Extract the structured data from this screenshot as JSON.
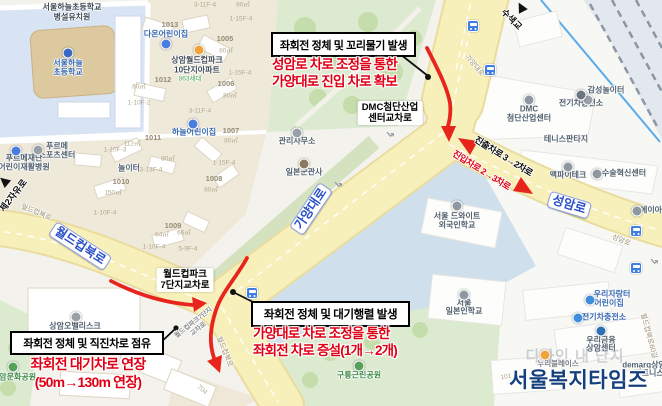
{
  "colors": {
    "red": "#e00016",
    "arrowred": "#e8251d",
    "roady": "#f8f0ba",
    "pillblue": "#2b50c8",
    "navy": "#16407d"
  },
  "annotations": {
    "top": {
      "issue": "좌회전 정체 및 꼬리물기 발생",
      "action1": "성암로 차로 조정을 통한",
      "action2": "가양대로 진입 차로 확보"
    },
    "bottom_center": {
      "issue": "좌회전 정체 및 대기행렬 발생",
      "action1": "가양대로 차로 조정을 통한",
      "action2": "좌회전 차로 증설(1개→2개)"
    },
    "bottom_left": {
      "issue": "좌회전 정체 및 직진차로 점유",
      "action1": "좌회전 대기차로 연장",
      "action2": "(50m→130m 연장)"
    }
  },
  "watermark": {
    "text": "서울복지타임즈"
  },
  "map": {
    "labels": [
      {
        "t": "서울하늘초등학교",
        "x": 72,
        "y": 8,
        "c": "poid"
      },
      {
        "t": "병설유치원",
        "x": 72,
        "y": 18,
        "c": "poid"
      },
      {
        "t": "서울하늘",
        "x": 68,
        "y": 64,
        "c": "poib"
      },
      {
        "t": "초등학교",
        "x": 68,
        "y": 73,
        "c": "poib"
      },
      {
        "t": "다온어린이집",
        "x": 166,
        "y": 35,
        "c": "poib"
      },
      {
        "t": "1013",
        "x": 170,
        "y": 25,
        "c": "bn"
      },
      {
        "t": "상암월드컵파크",
        "x": 197,
        "y": 61,
        "c": "poid"
      },
      {
        "t": "10단지아파트",
        "x": 197,
        "y": 71,
        "c": "poid"
      },
      {
        "t": "863세대",
        "x": 190,
        "y": 79,
        "c": "gsm"
      },
      {
        "t": "1012",
        "x": 163,
        "y": 80,
        "c": "bn"
      },
      {
        "t": "하늘어린이집",
        "x": 194,
        "y": 133,
        "c": "poib"
      },
      {
        "t": "80㎡",
        "x": 243,
        "y": 5,
        "c": "pn"
      },
      {
        "t": "1-15F-4",
        "x": 241,
        "y": 19,
        "c": "pn"
      },
      {
        "t": "1005",
        "x": 225,
        "y": 39,
        "c": "bn"
      },
      {
        "t": "80㎡",
        "x": 226,
        "y": 51,
        "c": "pn"
      },
      {
        "t": "1-15F-4",
        "x": 240,
        "y": 73,
        "c": "pn"
      },
      {
        "t": "1006",
        "x": 226,
        "y": 84,
        "c": "bn"
      },
      {
        "t": "80㎡",
        "x": 230,
        "y": 96,
        "c": "pn"
      },
      {
        "t": "3-11F-4",
        "x": 205,
        "y": 5,
        "c": "pn"
      },
      {
        "t": "3-11F-4",
        "x": 200,
        "y": 111,
        "c": "pn"
      },
      {
        "t": "1-10F-2",
        "x": 139,
        "y": 103,
        "c": "pn"
      },
      {
        "t": "80㎡",
        "x": 139,
        "y": 87,
        "c": "pn"
      },
      {
        "t": "1011",
        "x": 153,
        "y": 138,
        "c": "bn"
      },
      {
        "t": "112㎡",
        "x": 132,
        "y": 144,
        "c": "pn"
      },
      {
        "t": "1-10F-3",
        "x": 115,
        "y": 150,
        "c": "pn"
      },
      {
        "t": "놀이터",
        "x": 129,
        "y": 169,
        "c": "poi"
      },
      {
        "t": "3-13F-4",
        "x": 151,
        "y": 170,
        "c": "pn"
      },
      {
        "t": "80㎡",
        "x": 168,
        "y": 159,
        "c": "pn"
      },
      {
        "t": "1010",
        "x": 121,
        "y": 182,
        "c": "bn"
      },
      {
        "t": "150㎡",
        "x": 113,
        "y": 193,
        "c": "pn"
      },
      {
        "t": "1-10F-4",
        "x": 105,
        "y": 213,
        "c": "pn"
      },
      {
        "t": "1008",
        "x": 214,
        "y": 179,
        "c": "bn"
      },
      {
        "t": "80㎡",
        "x": 211,
        "y": 190,
        "c": "pn"
      },
      {
        "t": "1-15F-4",
        "x": 224,
        "y": 163,
        "c": "pn"
      },
      {
        "t": "1007",
        "x": 231,
        "y": 131,
        "c": "bn"
      },
      {
        "t": "80㎡",
        "x": 231,
        "y": 141,
        "c": "pn"
      },
      {
        "t": "1009",
        "x": 173,
        "y": 226,
        "c": "bn"
      },
      {
        "t": "64㎡",
        "x": 162,
        "y": 235,
        "c": "pn"
      },
      {
        "t": "66㎡",
        "x": 184,
        "y": 233,
        "c": "pn"
      },
      {
        "t": "1-10F-4",
        "x": 154,
        "y": 247,
        "c": "pn"
      },
      {
        "t": "5-9F-4",
        "x": 188,
        "y": 249,
        "c": "pn"
      },
      {
        "t": "푸르메",
        "x": 57,
        "y": 147,
        "c": "poi"
      },
      {
        "t": "스포츠센터",
        "x": 57,
        "y": 156,
        "c": "poi"
      },
      {
        "t": "푸르메재단",
        "x": 24,
        "y": 159,
        "c": "poi"
      },
      {
        "t": "어린이재활병원",
        "x": 24,
        "y": 168,
        "c": "poi"
      },
      {
        "t": "제2자유로",
        "x": 14,
        "y": 196,
        "c": "rd",
        "r": -52,
        "n": "road-label-jeyjayuro"
      },
      {
        "t": "월드컵북로",
        "x": 36,
        "y": 213,
        "c": "rs",
        " r": 22,
        "r": 22
      },
      {
        "t": "월드컵북로",
        "x": 80,
        "y": 246,
        "c": "pill",
        "r": 33,
        "n": "road-label-worldcupbukro"
      },
      {
        "t": "가양대로",
        "x": 311,
        "y": 209,
        "c": "pill",
        "r": -56,
        "n": "road-label-gayangdaero"
      },
      {
        "t": "성암로",
        "x": 569,
        "y": 205,
        "c": "pill",
        "r": 17,
        "n": "road-label-seongamro"
      },
      {
        "t": "가양대로",
        "x": 474,
        "y": 66,
        "c": "rs",
        "r": 50
      },
      {
        "t": "수색교",
        "x": 511,
        "y": 20,
        "c": "rd",
        "r": 45,
        "n": "road-label-susaekgyo"
      },
      {
        "t": "성암로",
        "x": 621,
        "y": 241,
        "c": "rs",
        "r": 22
      },
      {
        "t": "월드컵북로",
        "x": 224,
        "y": 352,
        "c": "rs",
        "r": 68
      },
      {
        "t": "월드컵북로60길",
        "x": 648,
        "y": 336,
        "c": "rs",
        "r": 75
      },
      {
        "t": "상암오벨리스크",
        "x": 75,
        "y": 327,
        "c": "poi"
      },
      {
        "t": "상암문화공원",
        "x": 14,
        "y": 378,
        "c": "poig"
      },
      {
        "t": "월드컵파크\n7단지교차로",
        "x": 185,
        "y": 280,
        "c": "plate",
        "n": "intersection-label-worldcuppark"
      },
      {
        "t": "월드컵파크7단지\n교차로",
        "x": 196,
        "y": 326,
        "c": "xgray",
        "r": -38
      },
      {
        "t": "DMC첨단산업\n센터교차로",
        "x": 390,
        "y": 113,
        "c": "plate",
        "n": "intersection-label-dmc"
      },
      {
        "t": "관리사무소",
        "x": 297,
        "y": 142,
        "c": "poi"
      },
      {
        "t": "일본군관사",
        "x": 304,
        "y": 173,
        "c": "poi"
      },
      {
        "t": "감성놀이터",
        "x": 606,
        "y": 91,
        "c": "poi"
      },
      {
        "t": "DMC",
        "x": 529,
        "y": 110,
        "c": "poi"
      },
      {
        "t": "첨단산업센터",
        "x": 529,
        "y": 119,
        "c": "poi"
      },
      {
        "t": "전기차충전소",
        "x": 581,
        "y": 104,
        "c": "poi"
      },
      {
        "t": "테니스판타지",
        "x": 566,
        "y": 140,
        "c": "poi"
      },
      {
        "t": "맥파이테크",
        "x": 568,
        "y": 176,
        "c": "poi"
      },
      {
        "t": "수술혁신센터",
        "x": 624,
        "y": 174,
        "c": "poi"
      },
      {
        "t": "에이아",
        "x": 651,
        "y": 211,
        "c": "poi"
      },
      {
        "t": "서울 드와이트",
        "x": 457,
        "y": 217,
        "c": "poi"
      },
      {
        "t": "외국인학교",
        "x": 457,
        "y": 226,
        "c": "poi"
      },
      {
        "t": "서울",
        "x": 464,
        "y": 304,
        "c": "poi"
      },
      {
        "t": "일본인학교",
        "x": 464,
        "y": 312,
        "c": "poi"
      },
      {
        "t": "우리자랑터",
        "x": 612,
        "y": 295,
        "c": "poib"
      },
      {
        "t": "어린이집",
        "x": 609,
        "y": 304,
        "c": "poib"
      },
      {
        "t": "전기차충전소",
        "x": 604,
        "y": 318,
        "c": "poib"
      },
      {
        "t": "우리금융",
        "x": 601,
        "y": 341,
        "c": "poi"
      },
      {
        "t": "상암센터",
        "x": 601,
        "y": 349,
        "c": "poi"
      },
      {
        "t": "demarq상암",
        "x": 644,
        "y": 366,
        "c": "poi"
      },
      {
        "t": "피트니스",
        "x": 649,
        "y": 374,
        "c": "poi"
      },
      {
        "t": "구룡근린공원",
        "x": 359,
        "y": 376,
        "c": "poig"
      },
      {
        "t": "누리블레이스",
        "x": 558,
        "y": 364,
        "c": "faint"
      },
      {
        "t": "디자인 내 단지",
        "x": 575,
        "y": 357,
        "c": "ghost"
      },
      {
        "t": "704",
        "x": 202,
        "y": 390,
        "c": "pn",
        "r": 40
      },
      {
        "t": "101",
        "x": 506,
        "y": 377,
        "c": "pn",
        "r": -10
      },
      {
        "t": "진출차로 3→2차로",
        "x": 503,
        "y": 157,
        "c": "lanek",
        "r": 32,
        "n": "lane-exit-label"
      },
      {
        "t": "진입차로 2→3차로",
        "x": 481,
        "y": 171,
        "c": "laner",
        "r": 32,
        "n": "lane-entry-label"
      }
    ],
    "icons": [
      {
        "k": "dot",
        "x": 68,
        "y": 53,
        "color": "#3a69c1",
        "n": "school-marker-icon"
      },
      {
        "k": "dot",
        "x": 166,
        "y": 44,
        "color": "#4a7de0",
        "n": "daycare-marker-icon"
      },
      {
        "k": "dot",
        "x": 199,
        "y": 50,
        "color": "#f0a23c",
        "n": "apartment-marker-icon"
      },
      {
        "k": "dot",
        "x": 193,
        "y": 124,
        "color": "#4a7de0",
        "n": "daycare-marker-icon"
      },
      {
        "k": "dot",
        "x": 38,
        "y": 150,
        "color": "#9aa0a8",
        "n": "sports-center-marker-icon"
      },
      {
        "k": "dot",
        "x": 16,
        "y": 151,
        "color": "#4a7de0",
        "n": "hospital-marker-icon"
      },
      {
        "k": "dot",
        "x": 76,
        "y": 317,
        "color": "#9aa0a8",
        "n": "building-marker-icon"
      },
      {
        "k": "dot",
        "x": 13,
        "y": 367,
        "color": "#57a15a",
        "n": "park-marker-icon"
      },
      {
        "k": "dot",
        "x": 297,
        "y": 133,
        "color": "#9aa0a8",
        "n": "office-marker-icon"
      },
      {
        "k": "dot",
        "x": 304,
        "y": 164,
        "color": "#8a7a5f",
        "n": "historic-site-marker-icon"
      },
      {
        "k": "dot",
        "x": 588,
        "y": 100,
        "color": "#9aa0a8",
        "n": "playground-marker-icon"
      },
      {
        "k": "dot",
        "x": 529,
        "y": 100,
        "color": "#8f98a1",
        "n": "dmc-center-marker-icon"
      },
      {
        "k": "dot",
        "x": 581,
        "y": 95,
        "color": "#6b7680",
        "n": "ev-charger-marker-icon"
      },
      {
        "k": "dot",
        "x": 568,
        "y": 167,
        "color": "#8f98a1",
        "n": "company-marker-icon"
      },
      {
        "k": "dot",
        "x": 597,
        "y": 174,
        "color": "#8f98a1",
        "n": "clinic-marker-icon"
      },
      {
        "k": "dot",
        "x": 637,
        "y": 211,
        "color": "#8f98a1",
        "n": "company-marker-icon"
      },
      {
        "k": "dot",
        "x": 457,
        "y": 206,
        "color": "#8f98a1",
        "n": "school-marker-icon"
      },
      {
        "k": "dot",
        "x": 464,
        "y": 295,
        "color": "#8f98a1",
        "n": "school-marker-icon"
      },
      {
        "k": "dot",
        "x": 590,
        "y": 300,
        "color": "#3f8edd",
        "n": "daycare-marker-icon"
      },
      {
        "k": "dot",
        "x": 578,
        "y": 318,
        "color": "#3f8edd",
        "n": "ev-charger-marker-icon"
      },
      {
        "k": "dot",
        "x": 601,
        "y": 331,
        "color": "#2f6fb8",
        "n": "bank-marker-icon"
      },
      {
        "k": "dot",
        "x": 359,
        "y": 366,
        "color": "#57a15a",
        "n": "park-marker-icon"
      },
      {
        "k": "dot",
        "x": 545,
        "y": 355,
        "color": "#f0a23c",
        "n": "shop-marker-icon"
      },
      {
        "k": "bus",
        "x": 473,
        "y": 26
      },
      {
        "k": "bus",
        "x": 490,
        "y": 70
      },
      {
        "k": "bus",
        "x": 252,
        "y": 293
      },
      {
        "k": "bus",
        "x": 636,
        "y": 231
      },
      {
        "k": "bus",
        "x": 636,
        "y": 268
      },
      {
        "k": "uturn",
        "x": 390,
        "y": 133,
        "r": 140
      },
      {
        "k": "uturn",
        "x": 338,
        "y": 183,
        "r": 140
      },
      {
        "k": "uturn",
        "x": 654,
        "y": 260,
        "r": 140
      },
      {
        "k": "tri",
        "x": 521,
        "y": 7,
        "r": -28,
        "n": "road-direction-arrow-icon"
      },
      {
        "k": "tri",
        "x": 4,
        "y": 181,
        "r": -50,
        "n": "road-direction-arrow-icon"
      }
    ]
  }
}
